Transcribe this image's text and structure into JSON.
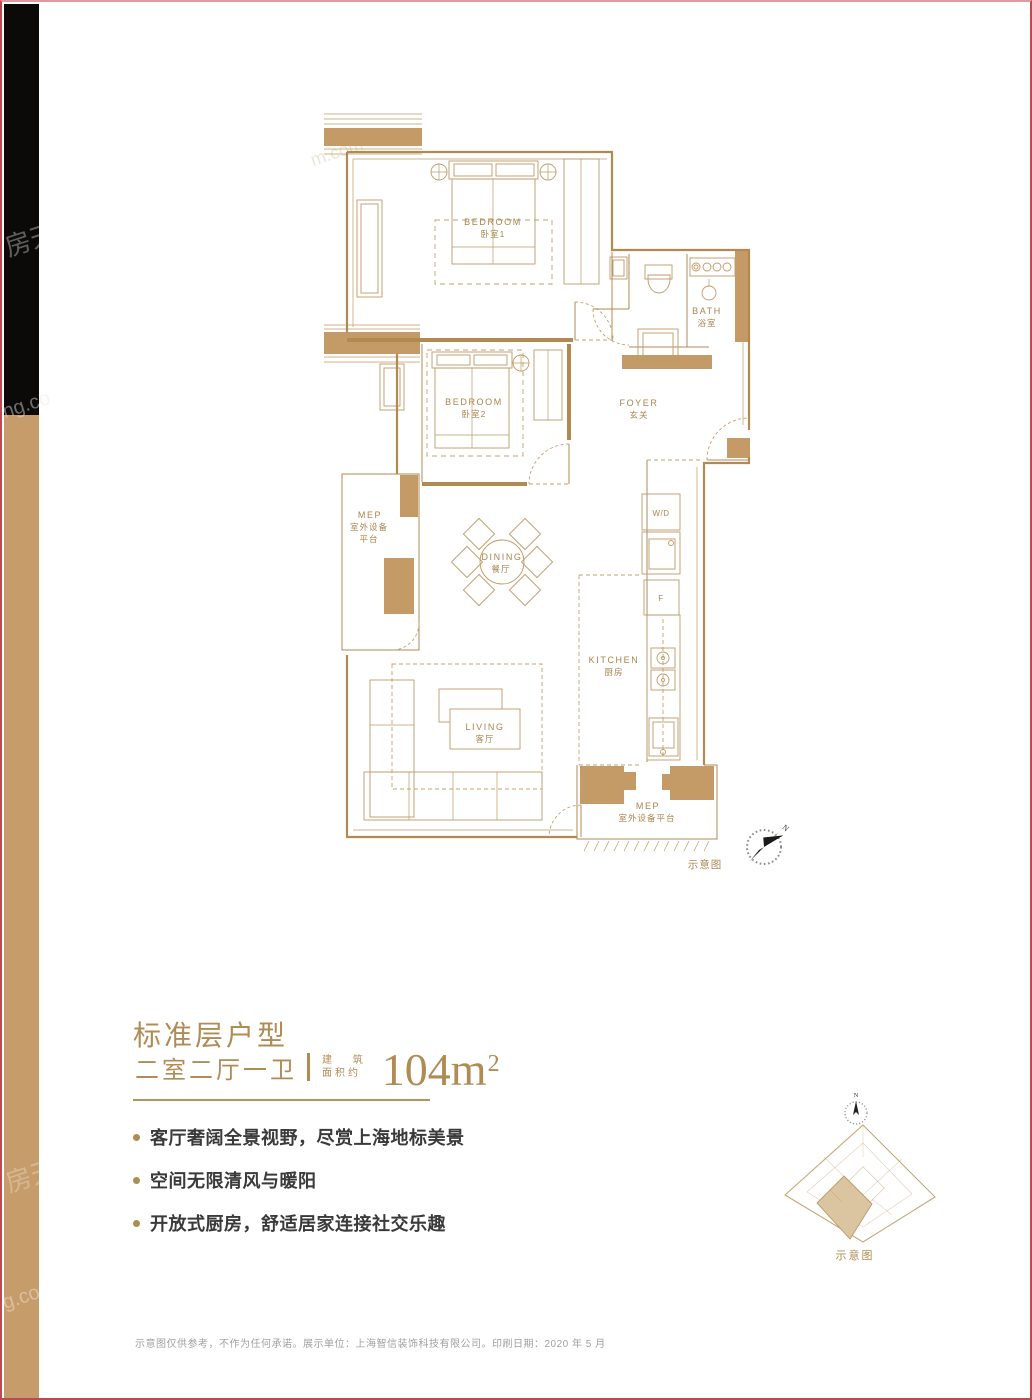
{
  "plan": {
    "rooms": {
      "bedroom1": {
        "en": "BEDROOM",
        "cn": "卧室1"
      },
      "bedroom2": {
        "en": "BEDROOM",
        "cn": "卧室2"
      },
      "bath": {
        "en": "BATH",
        "cn": "浴室"
      },
      "foyer": {
        "en": "FOYER",
        "cn": "玄关"
      },
      "dining": {
        "en": "DINING",
        "cn": "餐厅"
      },
      "kitchen": {
        "en": "KITCHEN",
        "cn": "厨房"
      },
      "living": {
        "en": "LIVING",
        "cn": "客厅"
      },
      "mep_left": {
        "en": "MEP",
        "cn1": "室外设备",
        "cn2": "平台"
      },
      "mep_bottom": {
        "en": "MEP",
        "cn": "室外设备平台"
      }
    },
    "appliances": {
      "washer_dryer": "W/D",
      "fridge": "F"
    },
    "schematic_label": "示意图",
    "compass_n": "N"
  },
  "summary": {
    "title": "标准层户型",
    "layout": "二室二厅一卫",
    "area_qualifier_line1": "建 筑",
    "area_qualifier_line2": "面积约",
    "area_value": "104m",
    "area_sup": "2"
  },
  "features": [
    {
      "text": "客厅奢阔全景视野，尽赏上海地标美景"
    },
    {
      "text": "空间无限清风与暖阳"
    },
    {
      "text": "开放式厨房，舒适居家连接社交乐趣"
    }
  ],
  "keyplan": {
    "schematic_label": "示意图",
    "compass_n": "N"
  },
  "footer": {
    "disclaimer": "示意图仅供参考，不作为任何承诺。展示单位：上海智信装饰科技有限公司。印刷日期：2020 年 5 月"
  },
  "watermarks": [
    "房天",
    "ng.co",
    "房天下",
    "g.com",
    "m.com"
  ],
  "colors": {
    "accent_gold": "#b08c55",
    "wall_gold": "#c49b66",
    "border_red": "#c04850",
    "bar_black": "#0c0a08",
    "bar_gold": "#c69c6a"
  }
}
